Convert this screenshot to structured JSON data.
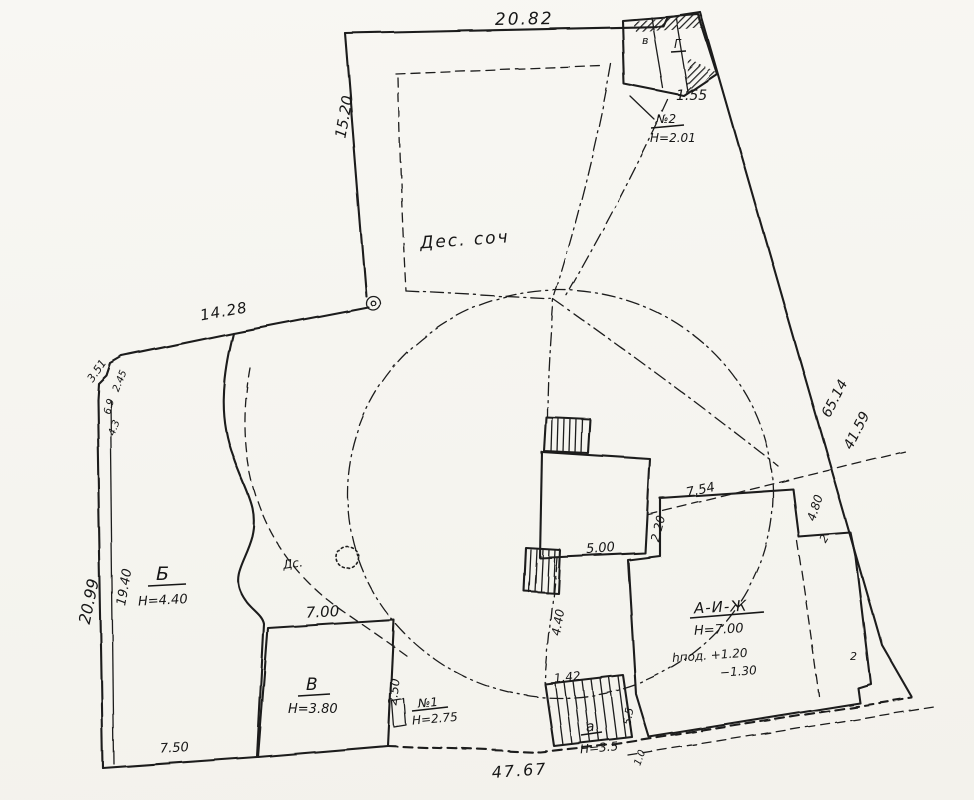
{
  "colors": {
    "ink": "#1d1d1d",
    "paper": "#f5f4ef"
  },
  "dims": {
    "top": "20.82",
    "left_upper": "15.20",
    "upper_slant": "14.28",
    "corner_a": "3.51",
    "corner_b": "2.45",
    "corner_c": "6.9",
    "corner_d": "4.3",
    "left_outer": "20.99",
    "left_inner": "19.40",
    "right_upper": "65.14",
    "right_lower": "41.59",
    "bottom": "47.67",
    "bottom_left": "7.50",
    "inner_500": "5.00",
    "inner_220": "2.20",
    "inner_754": "7.54",
    "inner_480": "4.80",
    "inner_2": "2",
    "inner_440": "4.40",
    "stair_width": "1.42",
    "stair_side": "5.5",
    "stair_bottom": "1.0",
    "edge_2": "2",
    "n2_front": "1.55"
  },
  "labels": {
    "site": "Дес. соч",
    "ds": "Дс.",
    "b": "Б",
    "b_h": "H=4.40",
    "v": "В",
    "v_h": "H=3.80",
    "v_top": "7.00",
    "v_side": "2.50",
    "n1": "№1",
    "n1_h": "H=2.75",
    "n2": "№2",
    "n2_h": "H=2.01",
    "n2_a": "в",
    "n2_b": "Г",
    "a": "А-И-Ж",
    "a_h": "H=7.00",
    "a_f1": "hпод. +1.20",
    "a_f2": "−1.30",
    "stair": "а",
    "stair_h": "H=3.5"
  }
}
